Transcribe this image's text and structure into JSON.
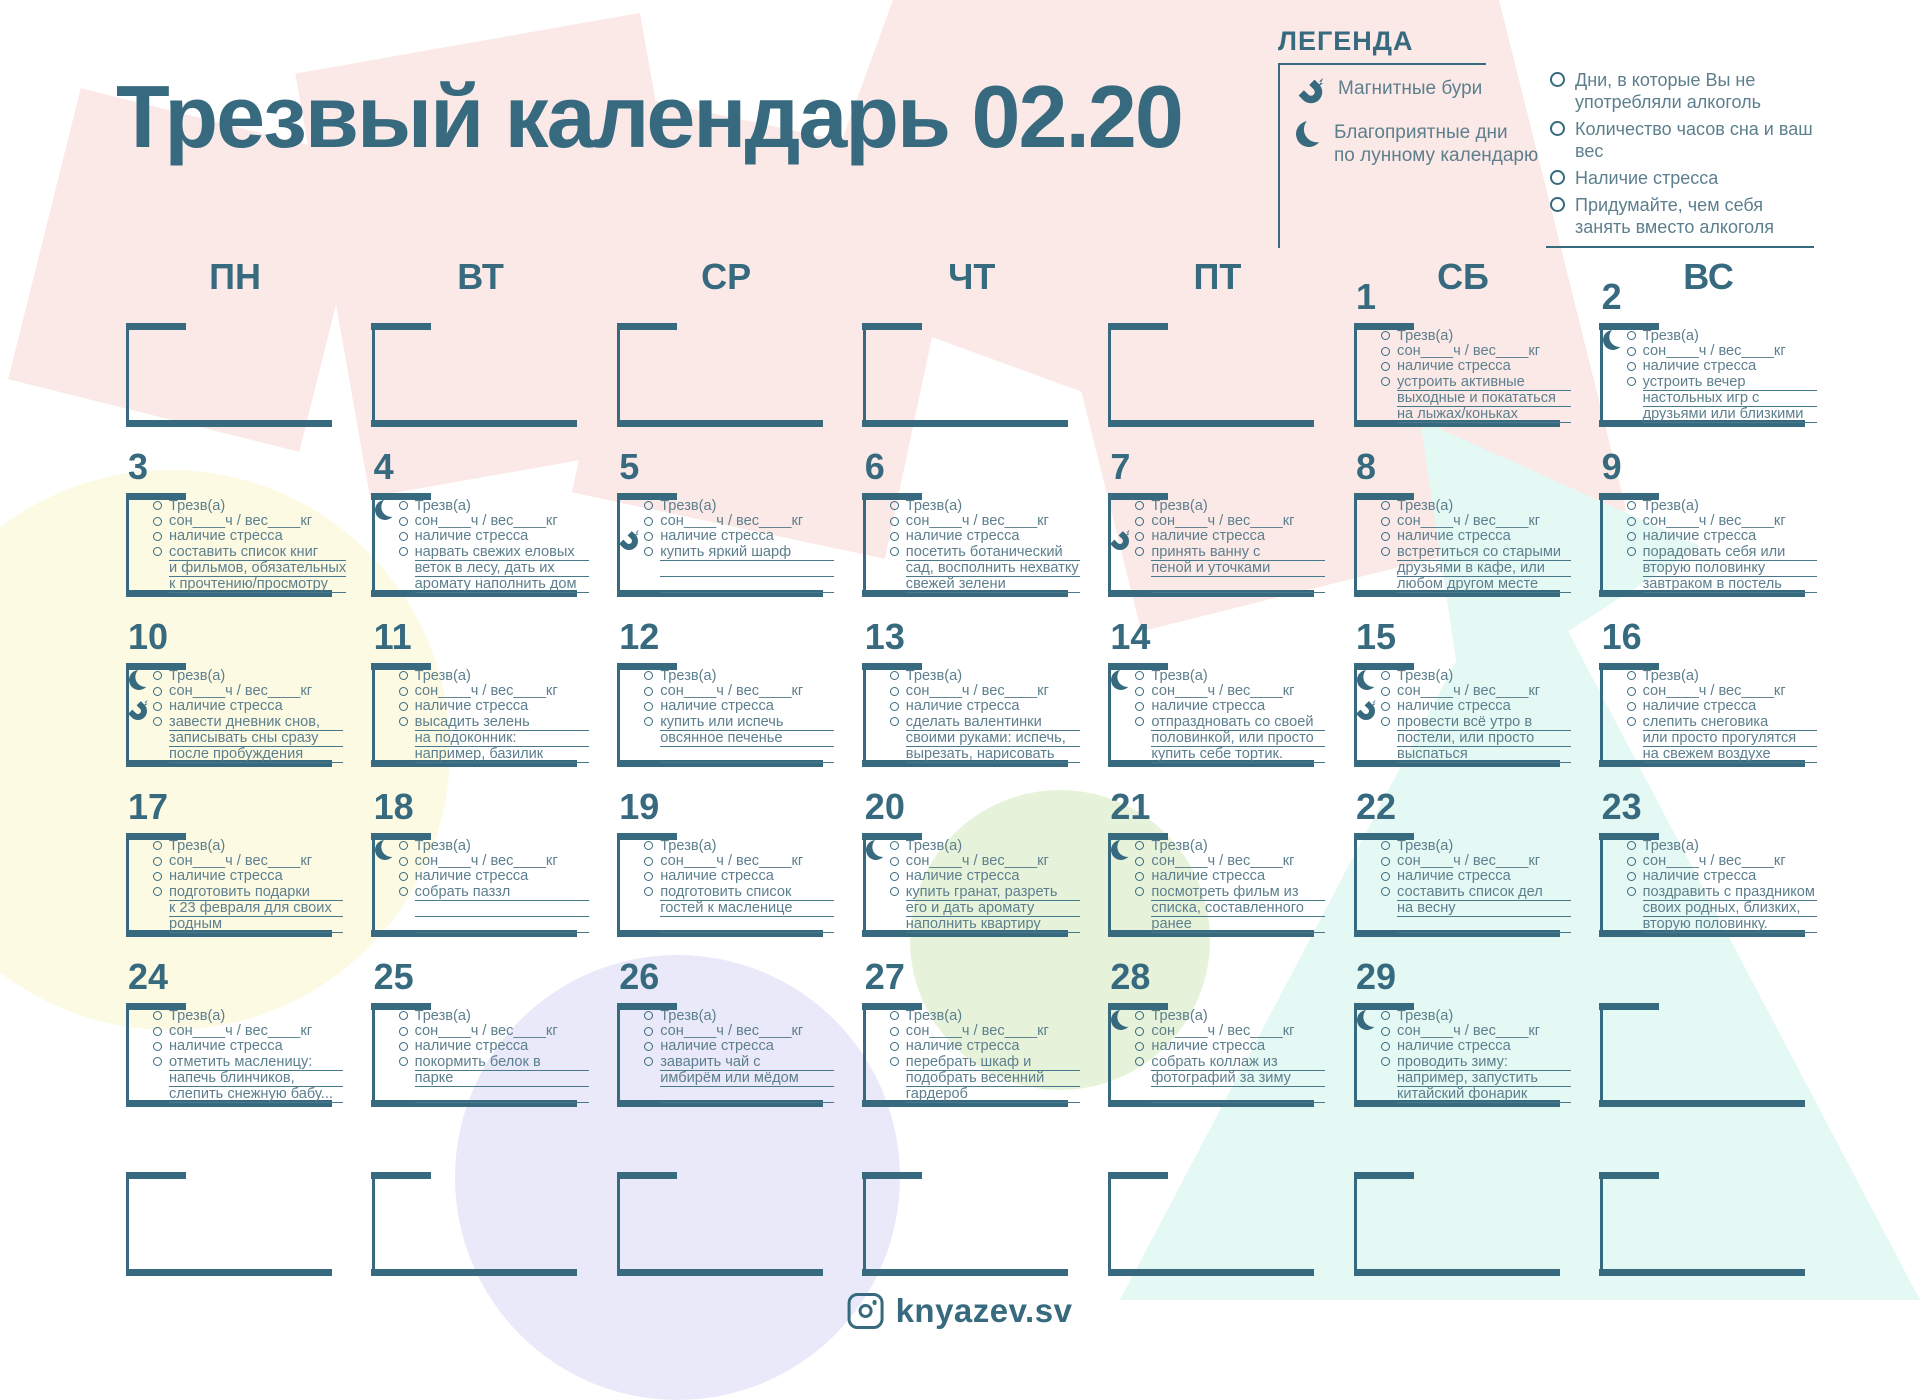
{
  "title": "Трезвый календарь 02.20",
  "legend": {
    "heading": "ЛЕГЕНДА",
    "items_left": [
      {
        "icon": "magnet-icon",
        "label": "Магнитные бури"
      },
      {
        "icon": "moon-icon",
        "label": "Благоприятные дни\nпо лунному календарю"
      }
    ],
    "items_right": [
      {
        "icon": "circle-icon",
        "label": "Дни, в которые Вы не\nупотребляли алкоголь"
      },
      {
        "icon": "circle-icon",
        "label": "Количество часов сна и ваш вес"
      },
      {
        "icon": "circle-icon",
        "label": "Наличие стресса"
      },
      {
        "icon": "circle-icon",
        "label": "Придумайте, чем себя\nзанять вместо алкоголя"
      }
    ]
  },
  "weekdays": [
    "ПН",
    "ВТ",
    "СР",
    "ЧТ",
    "ПТ",
    "СБ",
    "ВС"
  ],
  "checklist_defaults": [
    "Трезв(а)",
    "сон____ч / вес____кг",
    "наличие стресса"
  ],
  "days": [
    {
      "n": 1,
      "r": 0,
      "c": 5,
      "moon": false,
      "magnet": false,
      "task": [
        "устроить активные",
        "выходные и покататься",
        "на лыжах/коньках"
      ]
    },
    {
      "n": 2,
      "r": 0,
      "c": 6,
      "moon": true,
      "magnet": false,
      "task": [
        "устроить вечер",
        "настольных игр с",
        "друзьями или близкими"
      ]
    },
    {
      "n": 3,
      "r": 1,
      "c": 0,
      "moon": false,
      "magnet": false,
      "task": [
        "составить список книг",
        "и фильмов, обязательных",
        "к прочтению/просмотру"
      ]
    },
    {
      "n": 4,
      "r": 1,
      "c": 1,
      "moon": true,
      "magnet": false,
      "task": [
        "нарвать свежих еловых",
        "веток в лесу, дать их",
        "аромату наполнить дом"
      ]
    },
    {
      "n": 5,
      "r": 1,
      "c": 2,
      "moon": false,
      "magnet": true,
      "task": [
        "купить яркий шарф",
        "",
        ""
      ]
    },
    {
      "n": 6,
      "r": 1,
      "c": 3,
      "moon": false,
      "magnet": false,
      "task": [
        "посетить ботанический",
        "сад, восполнить нехватку",
        "свежей зелени"
      ]
    },
    {
      "n": 7,
      "r": 1,
      "c": 4,
      "moon": false,
      "magnet": true,
      "task": [
        "принять ванну с",
        "пеной и уточками",
        ""
      ]
    },
    {
      "n": 8,
      "r": 1,
      "c": 5,
      "moon": false,
      "magnet": false,
      "task": [
        "встретиться со старыми",
        "друзьями в кафе, или",
        "любом другом месте"
      ]
    },
    {
      "n": 9,
      "r": 1,
      "c": 6,
      "moon": false,
      "magnet": false,
      "task": [
        "порадовать себя или",
        "вторую половинку",
        "завтраком в постель"
      ]
    },
    {
      "n": 10,
      "r": 2,
      "c": 0,
      "moon": true,
      "magnet": true,
      "task": [
        "завести дневник снов,",
        "записывать сны сразу",
        "после пробуждения"
      ]
    },
    {
      "n": 11,
      "r": 2,
      "c": 1,
      "moon": false,
      "magnet": false,
      "task": [
        "высадить зелень",
        "на подоконник:",
        "например, базилик"
      ]
    },
    {
      "n": 12,
      "r": 2,
      "c": 2,
      "moon": false,
      "magnet": false,
      "task": [
        "купить или испечь",
        "овсянное печенье",
        ""
      ]
    },
    {
      "n": 13,
      "r": 2,
      "c": 3,
      "moon": false,
      "magnet": false,
      "task": [
        "сделать валентинки",
        "своими руками: испечь,",
        "вырезать, нарисовать"
      ]
    },
    {
      "n": 14,
      "r": 2,
      "c": 4,
      "moon": true,
      "magnet": false,
      "task": [
        "отпраздновать со своей",
        "половинкой, или просто",
        "купить себе тортик."
      ]
    },
    {
      "n": 15,
      "r": 2,
      "c": 5,
      "moon": true,
      "magnet": true,
      "task": [
        "провести всё утро в",
        "постели, или просто",
        "выспаться"
      ]
    },
    {
      "n": 16,
      "r": 2,
      "c": 6,
      "moon": false,
      "magnet": false,
      "task": [
        "слепить снеговика",
        "или просто прогулятся",
        "на свежем воздухе"
      ]
    },
    {
      "n": 17,
      "r": 3,
      "c": 0,
      "moon": false,
      "magnet": false,
      "task": [
        "подготовить подарки",
        "к 23 февраля для своих",
        "родным"
      ]
    },
    {
      "n": 18,
      "r": 3,
      "c": 1,
      "moon": true,
      "magnet": false,
      "task": [
        "собрать паззл",
        "",
        ""
      ]
    },
    {
      "n": 19,
      "r": 3,
      "c": 2,
      "moon": false,
      "magnet": false,
      "task": [
        "подготовить список",
        "гостей к масленице",
        ""
      ]
    },
    {
      "n": 20,
      "r": 3,
      "c": 3,
      "moon": true,
      "magnet": false,
      "task": [
        "купить гранат, разреть",
        "его и дать аромату",
        "наполнить квартиру"
      ]
    },
    {
      "n": 21,
      "r": 3,
      "c": 4,
      "moon": true,
      "magnet": false,
      "task": [
        "посмотреть фильм из",
        "списка, составленного",
        "ранее"
      ]
    },
    {
      "n": 22,
      "r": 3,
      "c": 5,
      "moon": false,
      "magnet": false,
      "task": [
        "составить список дел",
        "на весну",
        ""
      ]
    },
    {
      "n": 23,
      "r": 3,
      "c": 6,
      "moon": false,
      "magnet": false,
      "task": [
        "поздравить с праздником",
        "своих родных, близких,",
        "вторую половинку."
      ]
    },
    {
      "n": 24,
      "r": 4,
      "c": 0,
      "moon": false,
      "magnet": false,
      "task": [
        "отметить масленицу:",
        "напечь блинчиков,",
        "слепить снежную бабу..."
      ]
    },
    {
      "n": 25,
      "r": 4,
      "c": 1,
      "moon": false,
      "magnet": false,
      "task": [
        "покормить белок в",
        "парке",
        ""
      ]
    },
    {
      "n": 26,
      "r": 4,
      "c": 2,
      "moon": false,
      "magnet": false,
      "task": [
        "заварить чай с",
        "имбирём или мёдом",
        ""
      ]
    },
    {
      "n": 27,
      "r": 4,
      "c": 3,
      "moon": false,
      "magnet": false,
      "task": [
        "перебрать шкаф и",
        "подобрать весенний",
        "гардероб"
      ]
    },
    {
      "n": 28,
      "r": 4,
      "c": 4,
      "moon": true,
      "magnet": false,
      "task": [
        "собрать коллаж из",
        "фотографий за зиму",
        ""
      ]
    },
    {
      "n": 29,
      "r": 4,
      "c": 5,
      "moon": true,
      "magnet": false,
      "task": [
        "проводить зиму:",
        "например, запустить",
        "китайский фонарик"
      ]
    }
  ],
  "empty_cells": [
    [
      0,
      0
    ],
    [
      0,
      1
    ],
    [
      0,
      2
    ],
    [
      0,
      3
    ],
    [
      0,
      4
    ],
    [
      4,
      6
    ],
    [
      5,
      0
    ],
    [
      5,
      1
    ],
    [
      5,
      2
    ],
    [
      5,
      3
    ],
    [
      5,
      4
    ],
    [
      5,
      5
    ],
    [
      5,
      6
    ]
  ],
  "footer": {
    "handle": "knyazev.sv"
  },
  "colors": {
    "teal": "#376a7e",
    "text": "#5d7f8d",
    "pink": "#fbe9e7",
    "yellow": "#fcfae2",
    "green": "#e6f3da",
    "lavender": "#e9e9fa",
    "cyan": "#e4f8f4"
  }
}
